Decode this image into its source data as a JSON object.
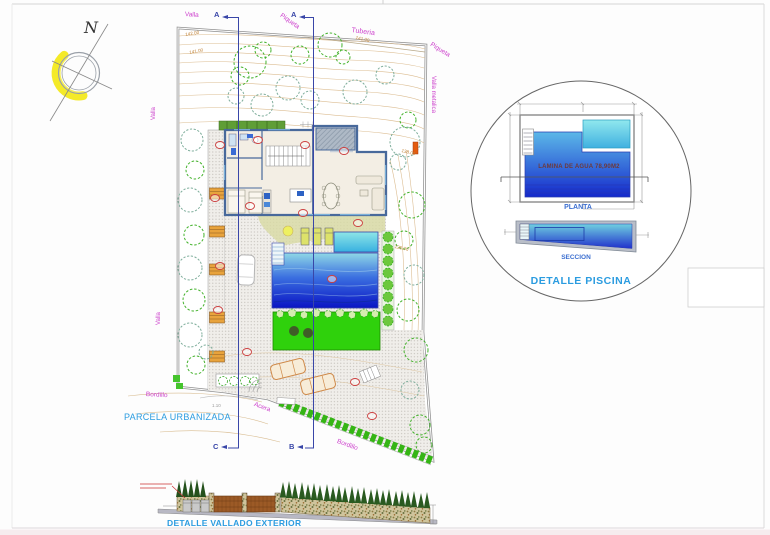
{
  "compass": {
    "north": "N"
  },
  "site": {
    "labels": {
      "valla_top": "Valla",
      "piqueta_top": "Piqueta",
      "tuberia": "Tuberia",
      "piqueta_right": "Piqueta",
      "valla_metalica": "Valla metalica",
      "valla_left_upper": "Valla",
      "valla_left_lower": "Valla",
      "bordillo_left": "Bordillo",
      "acera": "Acera",
      "bordillo_right": "Bordillo",
      "parcela": "PARCELA URBANIZADA",
      "dim_entry": "1.10"
    },
    "contours": {
      "c142": "142.00",
      "c141": "141.00",
      "c141b": "141.00",
      "c138": "138.00",
      "c135": "135.00"
    },
    "sections": {
      "top_left": "A",
      "top_right": "A",
      "bottom_left": "C",
      "bottom_right": "B"
    }
  },
  "pool_detail": {
    "water_area": "LAMINA DE AGUA 78,90M2",
    "plan": "PLANTA",
    "section": "SECCION",
    "title": "DETALLE PISCINA"
  },
  "fence_detail": {
    "title": "DETALLE VALLADO EXTERIOR"
  },
  "colors": {
    "pool_top": "#8fd8e6",
    "pool_mid": "#3a6ee0",
    "pool_bottom": "#0a14c4",
    "lawn": "#2fd10c",
    "hedge_green": "#35b515",
    "magenta": "#cc3fcc",
    "cyan_label": "#2b9ce0",
    "blue_label": "#3c6fd0",
    "section_blue": "#3946a8",
    "contour": "#c08236",
    "lamina_text": "#6e3a3a"
  }
}
